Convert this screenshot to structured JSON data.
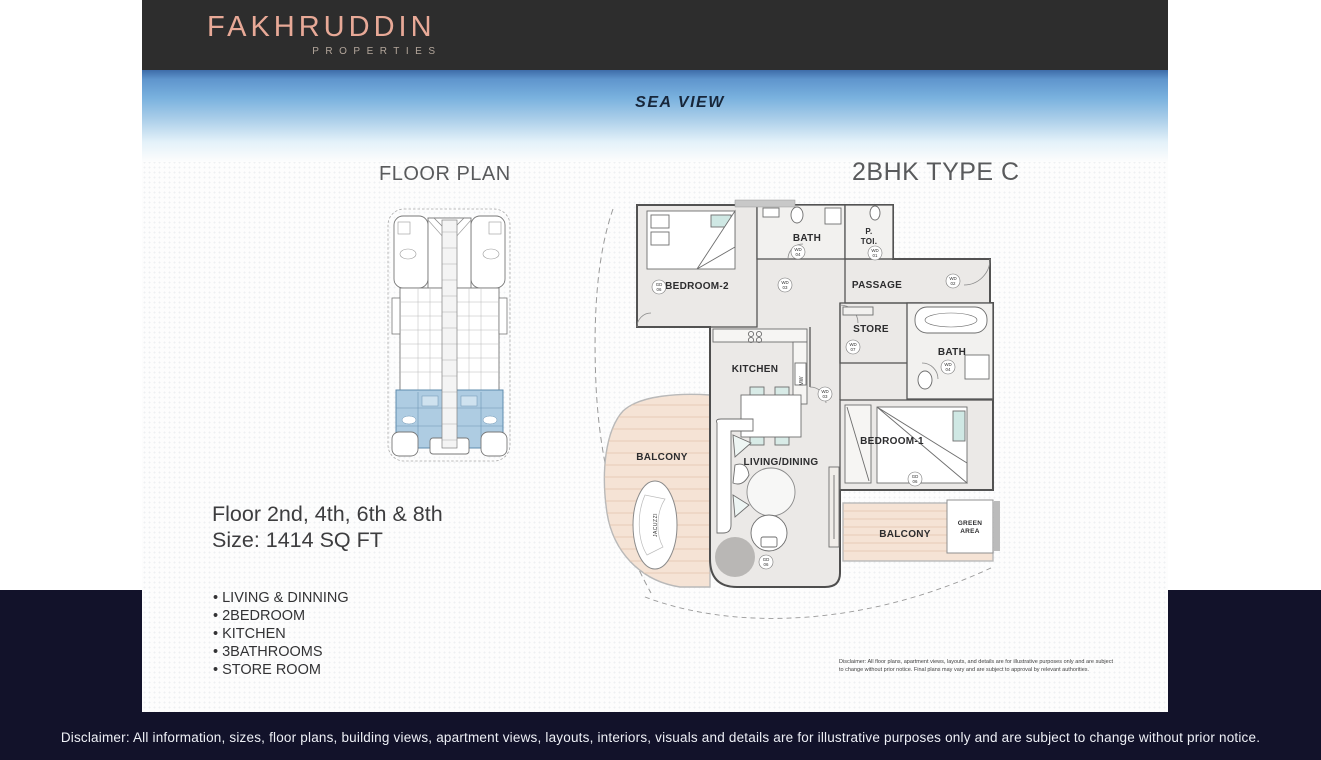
{
  "header": {
    "logo_title": "FAKHRUDDIN",
    "logo_subtitle": "PROPERTIES"
  },
  "hero": {
    "label": "SEA VIEW"
  },
  "floor_plan_section": {
    "title": "FLOOR PLAN",
    "floor_text": "Floor 2nd, 4th, 6th & 8th",
    "size_text": "Size: 1414 SQ FT",
    "features": [
      "LIVING & DINNING",
      "2BEDROOM",
      "KITCHEN",
      "3BATHROOMS",
      "STORE ROOM"
    ]
  },
  "unit_section": {
    "title": "2BHK TYPE C",
    "disclaimer": "Disclaimer: All floor plans, apartment views, layouts, and details are for illustrative purposes only and are subject to change without prior notice. Final plans may vary and are subject to approval by relevant authorities."
  },
  "plan": {
    "rooms": {
      "bath_top": "BATH",
      "ptoi_line1": "P.",
      "ptoi_line2": "TOI.",
      "bedroom2": "BEDROOM-2",
      "passage": "PASSAGE",
      "store": "STORE",
      "bath_right": "BATH",
      "kitchen": "KITCHEN",
      "bedroom1": "BEDROOM-1",
      "living": "LIVING/DINING",
      "balcony_left": "BALCONY",
      "balcony_bottom": "BALCONY",
      "green_line1": "GREEN",
      "green_line2": "AREA",
      "jacuzzi": "JACUZZI",
      "mw": "MW"
    },
    "door_tags": [
      {
        "t": "WD",
        "n": "04"
      },
      {
        "t": "WD",
        "n": "03"
      },
      {
        "t": "WD",
        "n": "01"
      },
      {
        "t": "WD",
        "n": "02"
      },
      {
        "t": "GD",
        "n": "06"
      },
      {
        "t": "WD",
        "n": "07"
      },
      {
        "t": "WD",
        "n": "03"
      },
      {
        "t": "WD",
        "n": "04"
      },
      {
        "t": "GD",
        "n": "06"
      },
      {
        "t": "GD",
        "n": "06"
      }
    ]
  },
  "footer": {
    "disclaimer": "Disclaimer: All information, sizes, floor plans, building views, apartment views, layouts, interiors, visuals and details are for illustrative purposes only and are subject to change without prior notice."
  },
  "colors": {
    "accent_salmon": "#e8a997",
    "footer_navy": "#12122a",
    "sea_blue": "#5f95cd",
    "keyplan_highlight": "#aecce2",
    "balcony_tan": "#f5e3d5"
  }
}
